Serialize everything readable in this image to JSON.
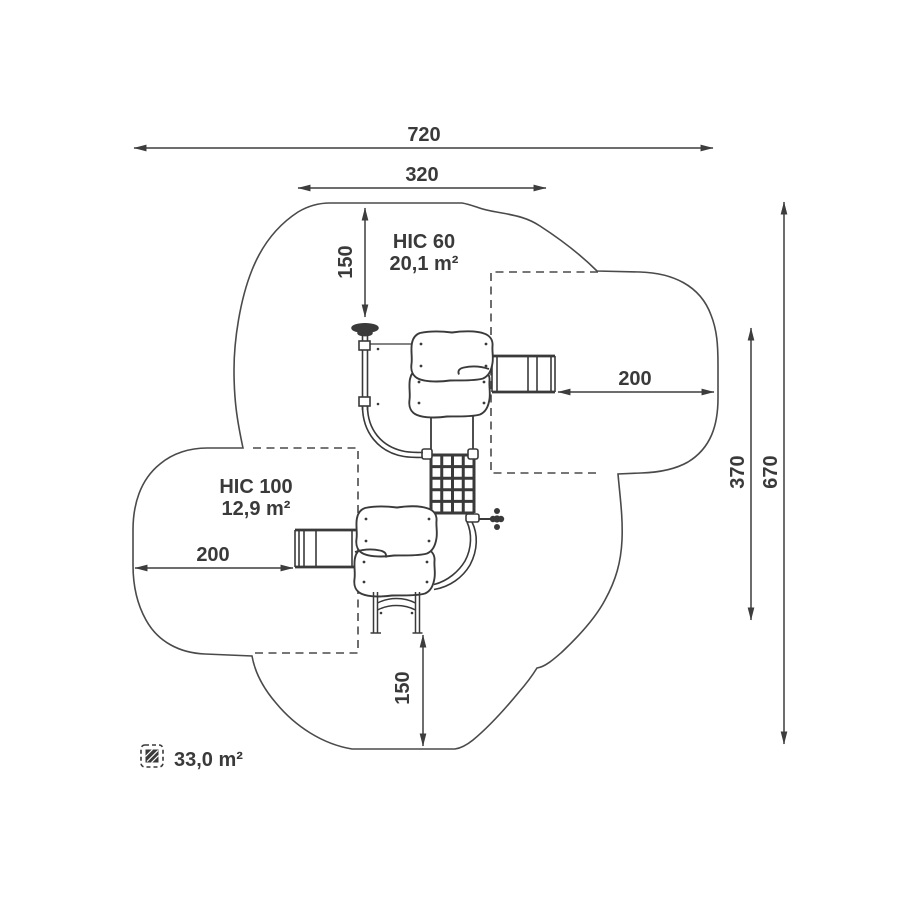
{
  "page": {
    "background": "#ffffff"
  },
  "colors": {
    "line": "#3d3d3d",
    "text": "#3a3a3a"
  },
  "dimensions": {
    "total_width": "720",
    "upper_zone_width": "320",
    "top_clearance": "150",
    "right_clearance": "200",
    "zone_height": "370",
    "total_height": "670",
    "left_clearance": "200",
    "bottom_clearance": "150"
  },
  "impact_zones": {
    "hic60": {
      "label": "HIC 60",
      "area": "20,1 m²"
    },
    "hic100": {
      "label": "HIC 100",
      "area": "12,9 m²"
    }
  },
  "legend": {
    "safety_area_total": "33,0 m²"
  }
}
